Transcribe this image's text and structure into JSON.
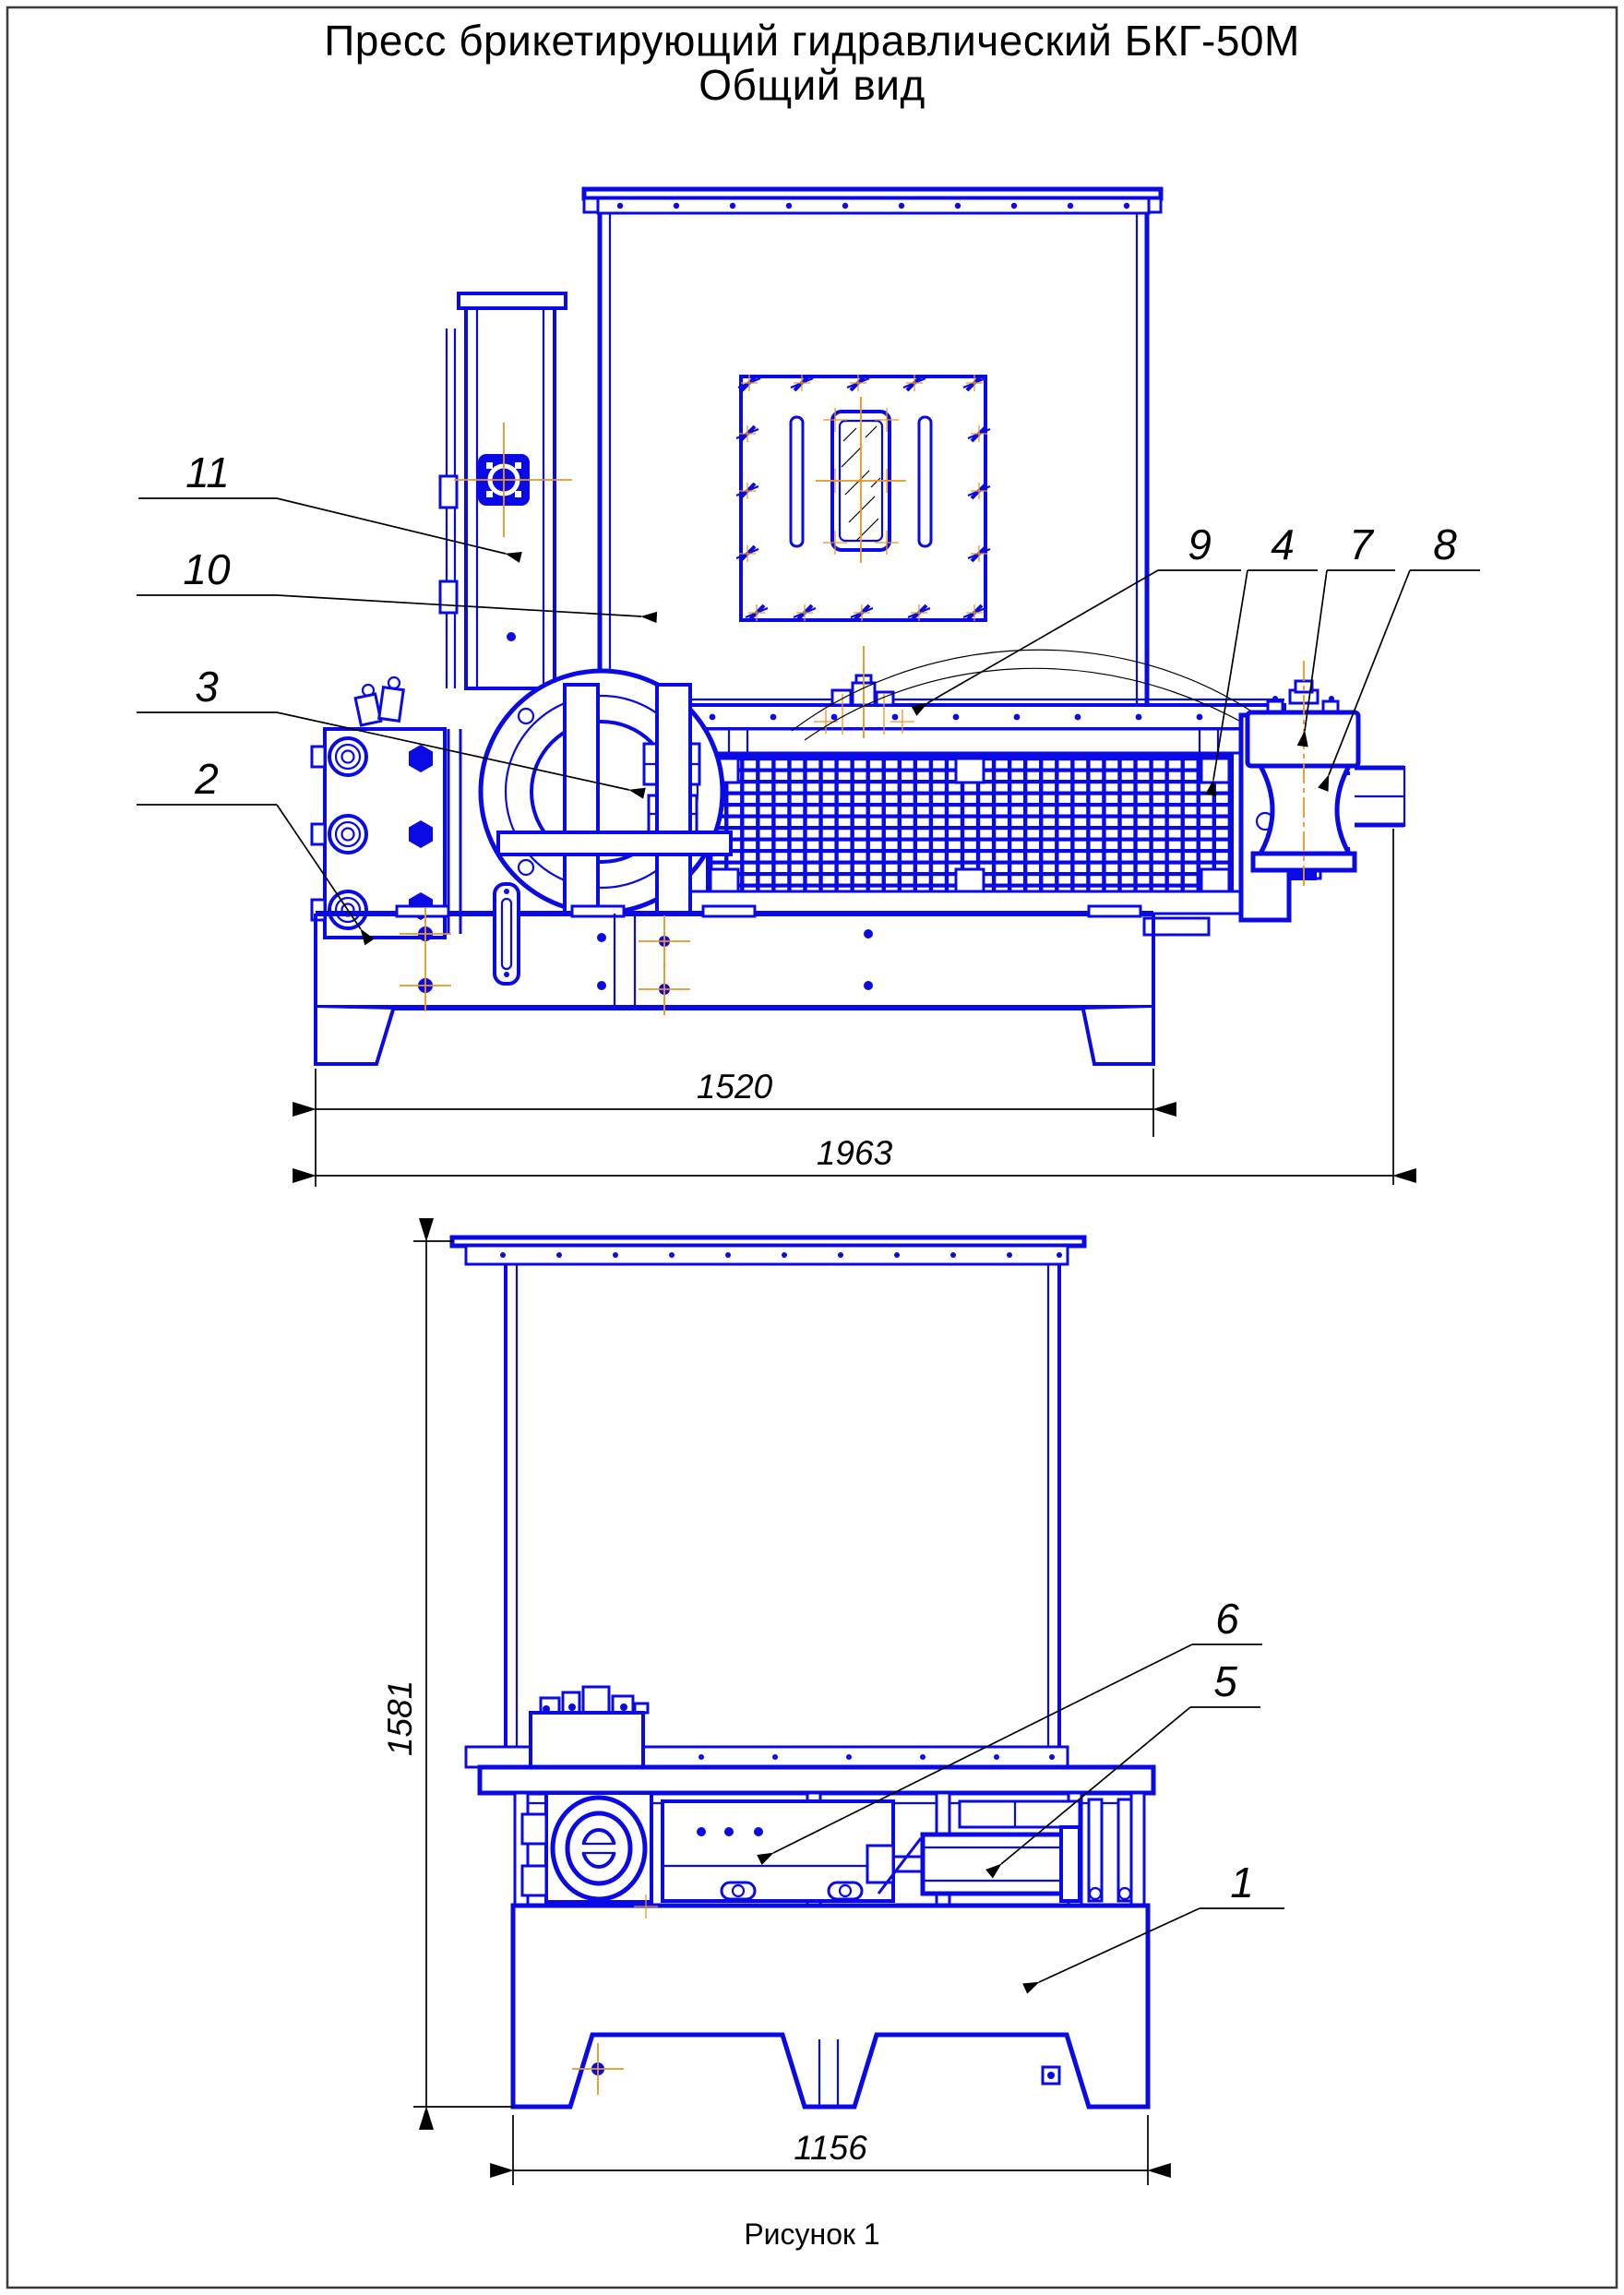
{
  "document": {
    "title_line1": "Пресс брикетирующий гидравлический БКГ-50М",
    "title_line2": "Общий вид",
    "figure_caption": "Рисунок 1"
  },
  "colors": {
    "drawing_blue": "#0a0ae6",
    "centerline_orange": "#e8971e",
    "annotation_black": "#000000",
    "paper_white": "#ffffff",
    "border_gray": "#3a3a3a"
  },
  "dimensions_mm": {
    "front_base_width": "1520",
    "front_overall_width": "1963",
    "side_overall_height": "1581",
    "side_base_width": "1156"
  },
  "callouts": {
    "c1": "1",
    "c2": "2",
    "c3": "3",
    "c4": "4",
    "c5": "5",
    "c6": "6",
    "c7": "7",
    "c8": "8",
    "c9": "9",
    "c10": "10",
    "c11": "11"
  }
}
